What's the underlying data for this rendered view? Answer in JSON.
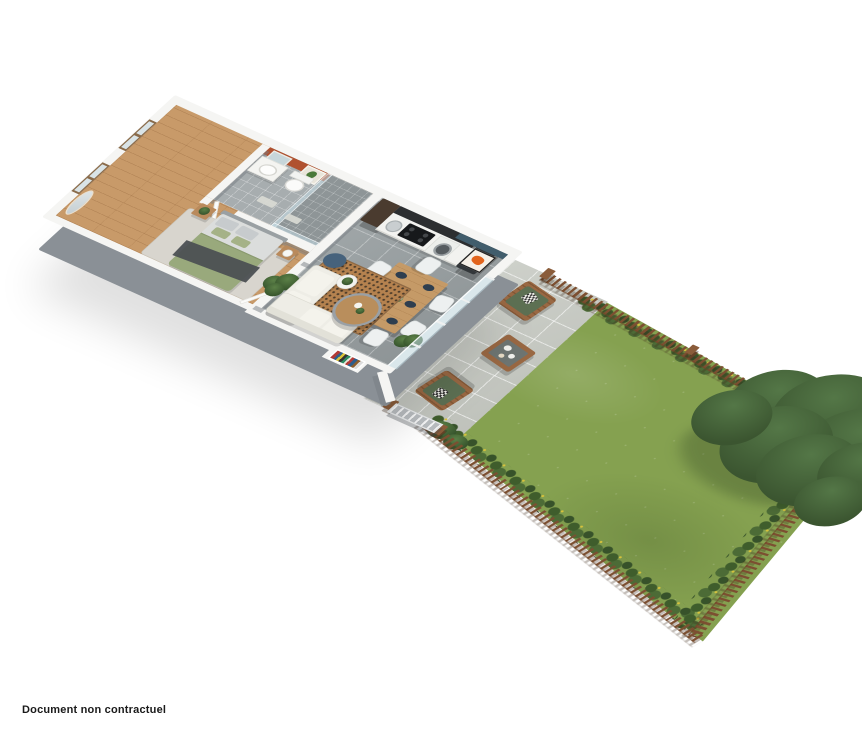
{
  "caption": {
    "text": "Document non contractuel"
  },
  "palette": {
    "background": "#ffffff",
    "wall": "#f5f5f3",
    "wall-face": "#8a9096",
    "wood": "#c89a69",
    "tile": "#99a0a2",
    "bath-tile": "#a7adaf",
    "shower-tile": "#8e9597",
    "terracotta": "#b0512f",
    "blue": "#415d6c",
    "art-orange": "#e2641c",
    "units-dark": "#2c2e30",
    "fridge": "#33373a",
    "counter": "#f2f2ef",
    "table-wood": "#c59a67",
    "chair": "#edf0f0",
    "plate": "#2e3e4f",
    "sofa": "#eeede6",
    "rug-living": "#b5824f",
    "rug-bedroom": "#d8d5ce",
    "pouf": "#46627c",
    "mattress": "#dbdddc",
    "duvet": "#99a97c",
    "throw": "#4c5053",
    "lawn": "#85a150",
    "hedge": "#44632f",
    "fence": "#7c4f31",
    "post": "#8a5c3a",
    "terrace": "#c9ccc5",
    "gate": "#b9bdc0",
    "glass": "rgba(195,219,228,0.55)",
    "cushion": "#5d7053",
    "outdoor-wood": "#996843",
    "tree-dark": "#3b5530",
    "tree-mid": "#547747",
    "trunk": "#5b4632",
    "text": "#1a1a1a"
  },
  "scene": {
    "type": "isometric-floor-plan-3d-render",
    "areas": [
      "bedroom",
      "bathroom",
      "kitchen",
      "living-room",
      "dining-area",
      "terrace",
      "garden"
    ]
  }
}
